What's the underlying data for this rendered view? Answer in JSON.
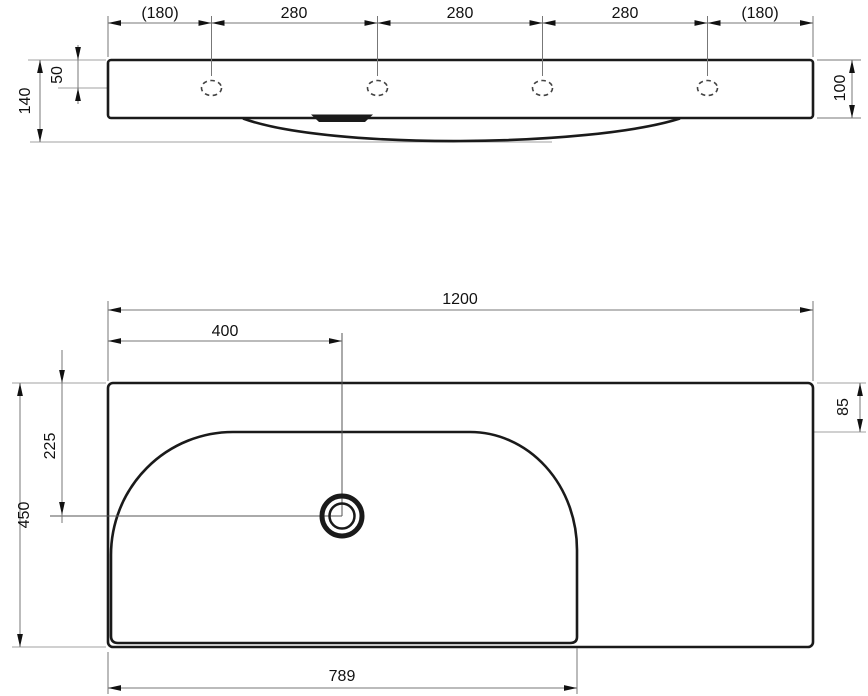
{
  "colors": {
    "outline": "#1a1a1a",
    "dimension_lines": "#777777",
    "reference_lines": "#b3b3b3",
    "label_text": "#111111",
    "background": "#ffffff"
  },
  "front_view": {
    "dim_left_spacing": "(180)",
    "dim_spacing_1": "280",
    "dim_spacing_2": "280",
    "dim_spacing_3": "280",
    "dim_right_spacing": "(180)",
    "dim_hole_offset": "50",
    "dim_total_height": "140",
    "dim_body_height": "100"
  },
  "plan_view": {
    "dim_overall_width": "1200",
    "dim_drain_from_left": "400",
    "dim_rim_to_bowl": "85",
    "dim_drain_from_back": "225",
    "dim_overall_depth": "450",
    "dim_bowl_length": "789"
  }
}
